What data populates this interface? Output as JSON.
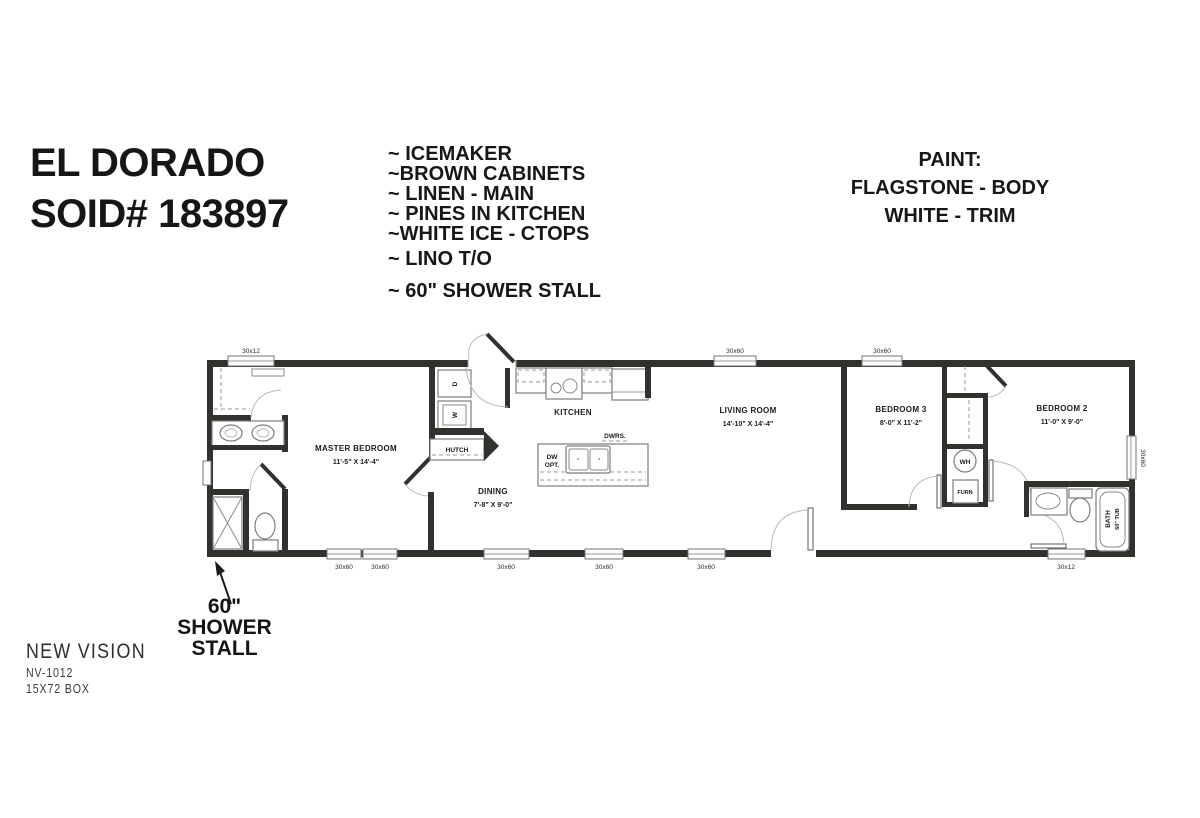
{
  "title": {
    "line1": "EL DORADO",
    "line2": "SOID# 183897"
  },
  "features": [
    "~ ICEMAKER",
    "~BROWN CABINETS",
    "~ LINEN - MAIN",
    "~ PINES IN KITCHEN",
    "~WHITE ICE - CTOPS",
    "~ LINO T/O",
    "~ 60\" SHOWER STALL"
  ],
  "paint": {
    "heading": "PAINT:",
    "body_line": "FLAGSTONE - BODY",
    "trim_line": "WHITE - TRIM"
  },
  "floor_plan": {
    "rooms": [
      {
        "name": "MASTER BEDROOM",
        "dims": "11'-5\" X 14'-4\""
      },
      {
        "name": "DINING",
        "dims": "7'-8\" X 9'-0\""
      },
      {
        "name": "KITCHEN",
        "dims": ""
      },
      {
        "name": "LIVING ROOM",
        "dims": "14'-10\" X 14'-4\""
      },
      {
        "name": "BEDROOM 3",
        "dims": "8'-0\" X 11'-2\""
      },
      {
        "name": "BEDROOM 2",
        "dims": "11'-0\" X 9'-0\""
      }
    ],
    "fixtures": {
      "dryer": "D",
      "washer": "W",
      "hutch": "HUTCH",
      "dw_opt_line1": "DW",
      "dw_opt_line2": "OPT.",
      "drawers": "DWRS.",
      "water_heater": "WH",
      "furnace": "FURN",
      "bath_line1": "BATH",
      "bath_line2": "60\" TUB"
    },
    "windows": {
      "top": [
        "30x12",
        "30x60",
        "30x60"
      ],
      "bottom": [
        "30x60",
        "30x60",
        "30x60",
        "30x60",
        "30x60",
        "30x12"
      ],
      "right": [
        "30x60"
      ]
    }
  },
  "callout": {
    "line1": "60\"",
    "line2": "SHOWER",
    "line3": "STALL"
  },
  "footer": {
    "brand": "NEW VISION",
    "model": "NV-1012",
    "box": "15X72 BOX"
  }
}
